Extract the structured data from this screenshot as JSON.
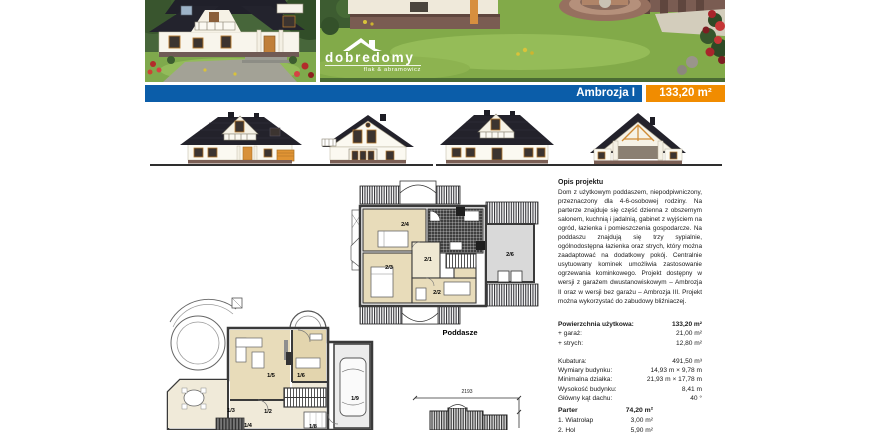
{
  "brand": {
    "logo": "dobredomy",
    "tagline": "flak & abramowicz"
  },
  "banner": {
    "title": "Ambrozja I",
    "area": "133,20 m²",
    "blue": "#0b5da9",
    "orange": "#f18c00"
  },
  "plans": {
    "attic_label": "Poddasze",
    "attic_rooms": {
      "r1": "2/1",
      "r2": "2/2",
      "r3": "2/3",
      "r4": "2/4",
      "r6": "2/6"
    },
    "ground_rooms": {
      "r2": "1/2",
      "r3": "1/3",
      "r4": "1/4",
      "r5": "1/5",
      "r6": "1/6",
      "r8": "1/8",
      "r9": "1/9"
    },
    "roof_dim_width": "2193"
  },
  "description": {
    "heading": "Opis projektu",
    "body": "Dom z użytkowym poddaszem, niepodpiwniczony, przeznaczony dla 4-6-osobowej rodziny. Na parterze znajduje się część dzienna z obszernym salonem, kuchnią i jadalnią, gabinet z wyjściem na ogród, łazienka i pomieszczenia gospodarcze. Na poddaszu znajdują się trzy sypialnie, ogólnodostępna łazienka oraz strych, który można zaadaptować na dodatkowy pokój. Centralnie usytuowany kominek umożliwia zastosowanie ogrzewania kominkowego. Projekt dostępny w wersji z garażem dwustanowiskowym – Ambrozja II oraz w wersji bez garażu – Ambrozja III. Projekt można wykorzystać do zabudowy bliźniaczej."
  },
  "specs": {
    "main": [
      {
        "label": "Powierzchnia użytkowa:",
        "value": "133,20 m²"
      },
      {
        "label": "+ garaż:",
        "value": "21,00 m²"
      },
      {
        "label": "+ strych:",
        "value": "12,80 m²"
      }
    ],
    "details": [
      {
        "label": "Kubatura:",
        "value": "491,50 m³"
      },
      {
        "label": "Wymiary budynku:",
        "value": "14,93 m × 9,78 m"
      },
      {
        "label": "Minimalna działka:",
        "value": "21,93 m × 17,78 m"
      },
      {
        "label": "Wysokość budynku:",
        "value": "8,41 m"
      },
      {
        "label": "Główny kąt dachu:",
        "value": "40 °"
      }
    ]
  },
  "ground_floor": {
    "heading": "Parter",
    "total": "74,20 m²",
    "rows": [
      {
        "label": "1. Wiatrołap",
        "value": "3,00 m²"
      },
      {
        "label": "2. Hol",
        "value": "5,90 m²"
      }
    ]
  }
}
